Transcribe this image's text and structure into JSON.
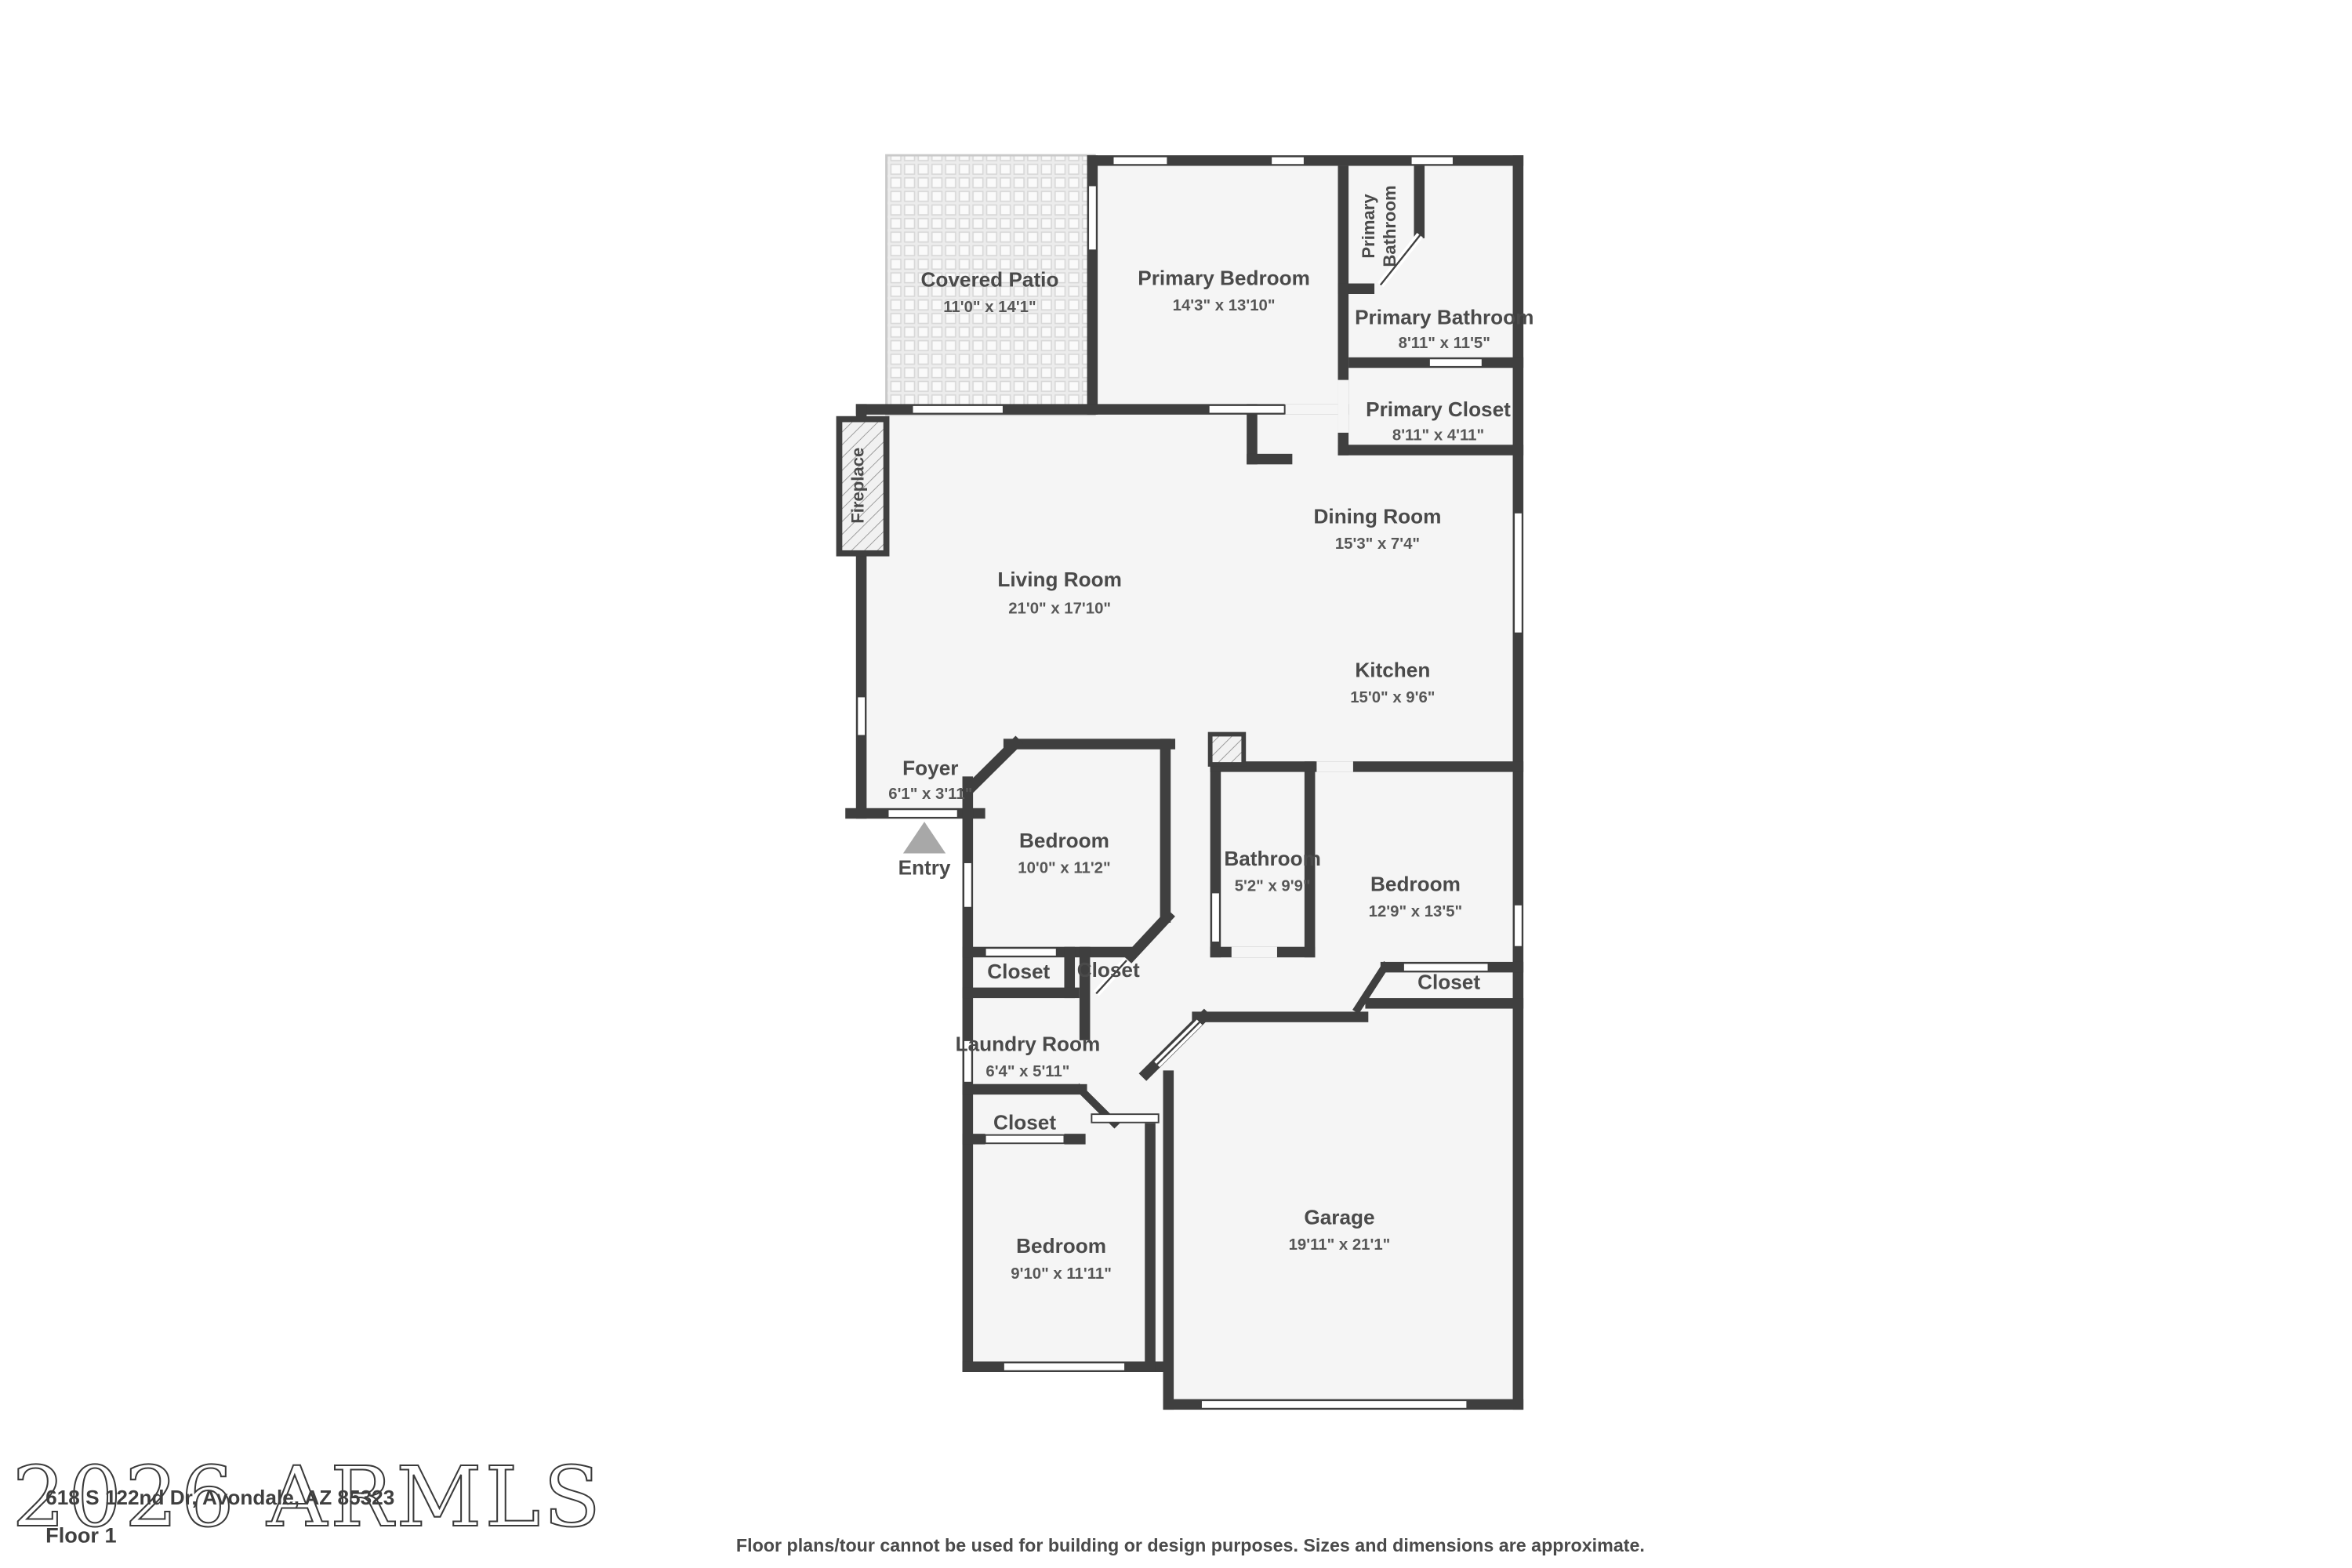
{
  "meta": {
    "address": "618 S 122nd Dr, Avondale, AZ 85323",
    "floor_label": "Floor 1",
    "disclaimer": "Floor plans/tour cannot be used for building or design purposes. Sizes and dimensions are approximate.",
    "watermark": "2026 ARMLS"
  },
  "colors": {
    "wall": "#3f3f3f",
    "floor": "#f5f5f5",
    "background": "#ffffff",
    "entry_arrow": "#a8a8a8"
  },
  "rooms": {
    "covered_patio": {
      "name": "Covered Patio",
      "dims": "11'0\" x 14'1\""
    },
    "primary_bedroom": {
      "name": "Primary Bedroom",
      "dims": "14'3\" x 13'10\""
    },
    "primary_bathroom_upper": {
      "line1": "Primary",
      "line2": "Bathroom"
    },
    "primary_bathroom": {
      "name": "Primary Bathroom",
      "dims": "8'11\" x 11'5\""
    },
    "primary_closet": {
      "name": "Primary Closet",
      "dims": "8'11\" x 4'11\""
    },
    "dining_room": {
      "name": "Dining Room",
      "dims": "15'3\" x 7'4\""
    },
    "living_room": {
      "name": "Living Room",
      "dims": "21'0\" x 17'10\""
    },
    "kitchen": {
      "name": "Kitchen",
      "dims": "15'0\" x 9'6\""
    },
    "foyer": {
      "name": "Foyer",
      "dims": "6'1\" x 3'11\""
    },
    "entry": {
      "name": "Entry"
    },
    "bedroom_2": {
      "name": "Bedroom",
      "dims": "10'0\" x 11'2\""
    },
    "bathroom_2": {
      "name": "Bathroom",
      "dims": "5'2\" x 9'9\""
    },
    "bedroom_3": {
      "name": "Bedroom",
      "dims": "12'9\" x 13'5\""
    },
    "closet_a": {
      "name": "Closet"
    },
    "closet_b": {
      "name": "Closet"
    },
    "laundry_room": {
      "name": "Laundry Room",
      "dims": "6'4\" x 5'11\""
    },
    "closet_c": {
      "name": "Closet"
    },
    "closet_d": {
      "name": "Closet"
    },
    "bedroom_4": {
      "name": "Bedroom",
      "dims": "9'10\" x 11'11\""
    },
    "garage": {
      "name": "Garage",
      "dims": "19'11\" x 21'1\""
    },
    "fireplace": {
      "name": "Fireplace"
    }
  }
}
